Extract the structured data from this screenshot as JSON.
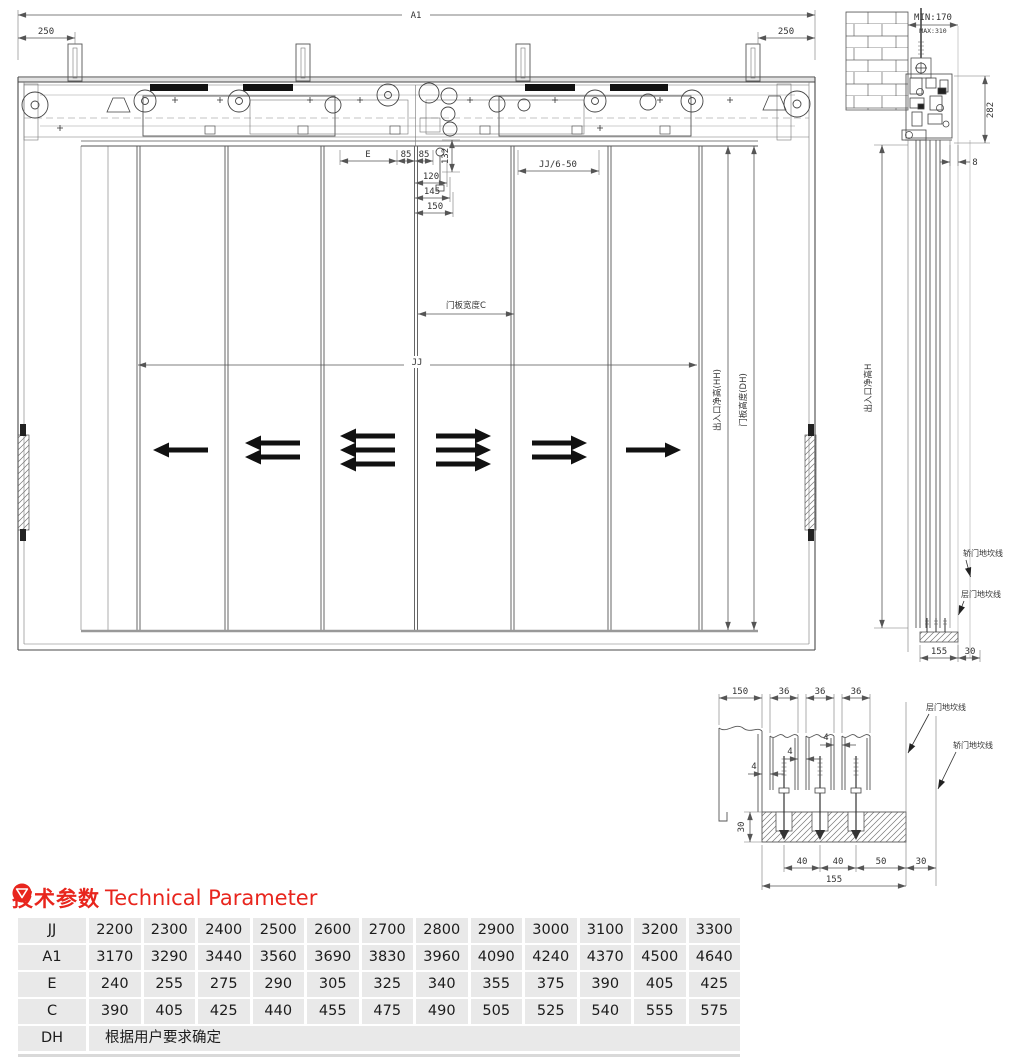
{
  "colors": {
    "accent_red": "#e8251d",
    "table_bg": "#e9e9e9",
    "line": "#555555"
  },
  "front_view": {
    "dim_a1": "A1",
    "dim_250_left": "250",
    "dim_250_right": "250",
    "dim_e": "E",
    "dim_85_left": "85",
    "dim_85_right": "85",
    "dim_132": "132",
    "dim_120": "120",
    "dim_145": "145",
    "dim_150": "150",
    "dim_jj_6_50": "JJ/6-50",
    "dim_door_width_c": "门板宽度C",
    "dim_jj": "JJ",
    "label_entrance_height": "出入口净高(HH)",
    "label_door_height": "门板高度(DH)",
    "panels": [
      {
        "arrows": 1,
        "dir": "left"
      },
      {
        "arrows": 2,
        "dir": "left"
      },
      {
        "arrows": 3,
        "dir": "left"
      },
      {
        "arrows": 3,
        "dir": "right"
      },
      {
        "arrows": 2,
        "dir": "right"
      },
      {
        "arrows": 1,
        "dir": "right"
      }
    ]
  },
  "side_view": {
    "dim_min": "MIN:170",
    "dim_max": "MAX:310",
    "dim_282": "282",
    "dim_8": "8",
    "dim_155": "155",
    "dim_30": "30",
    "label_entrance_height": "出入口净高H",
    "label_car_sill": "轿门地坎线",
    "label_landing_sill": "层门地坎线"
  },
  "detail_view": {
    "dim_150": "150",
    "dim_36_1": "36",
    "dim_36_2": "36",
    "dim_36_3": "36",
    "dim_4_1": "4",
    "dim_4_2": "4",
    "dim_4_3": "4",
    "dim_30": "30",
    "dim_40_1": "40",
    "dim_40_2": "40",
    "dim_50": "50",
    "dim_30b": "30",
    "dim_155": "155",
    "label_landing_sill": "层门地坎线",
    "label_car_sill": "轿门地坎线"
  },
  "heading": {
    "zh": "技术参数",
    "en": "Technical Parameter"
  },
  "table": {
    "rows": [
      {
        "label": "JJ",
        "values": [
          "2200",
          "2300",
          "2400",
          "2500",
          "2600",
          "2700",
          "2800",
          "2900",
          "3000",
          "3100",
          "3200",
          "3300"
        ]
      },
      {
        "label": "A1",
        "values": [
          "3170",
          "3290",
          "3440",
          "3560",
          "3690",
          "3830",
          "3960",
          "4090",
          "4240",
          "4370",
          "4500",
          "4640"
        ]
      },
      {
        "label": "E",
        "values": [
          "240",
          "255",
          "275",
          "290",
          "305",
          "325",
          "340",
          "355",
          "375",
          "390",
          "405",
          "425"
        ]
      },
      {
        "label": "C",
        "values": [
          "390",
          "405",
          "425",
          "440",
          "455",
          "475",
          "490",
          "505",
          "525",
          "540",
          "555",
          "575"
        ]
      },
      {
        "label": "DH",
        "note": "根据用户要求确定"
      }
    ]
  }
}
